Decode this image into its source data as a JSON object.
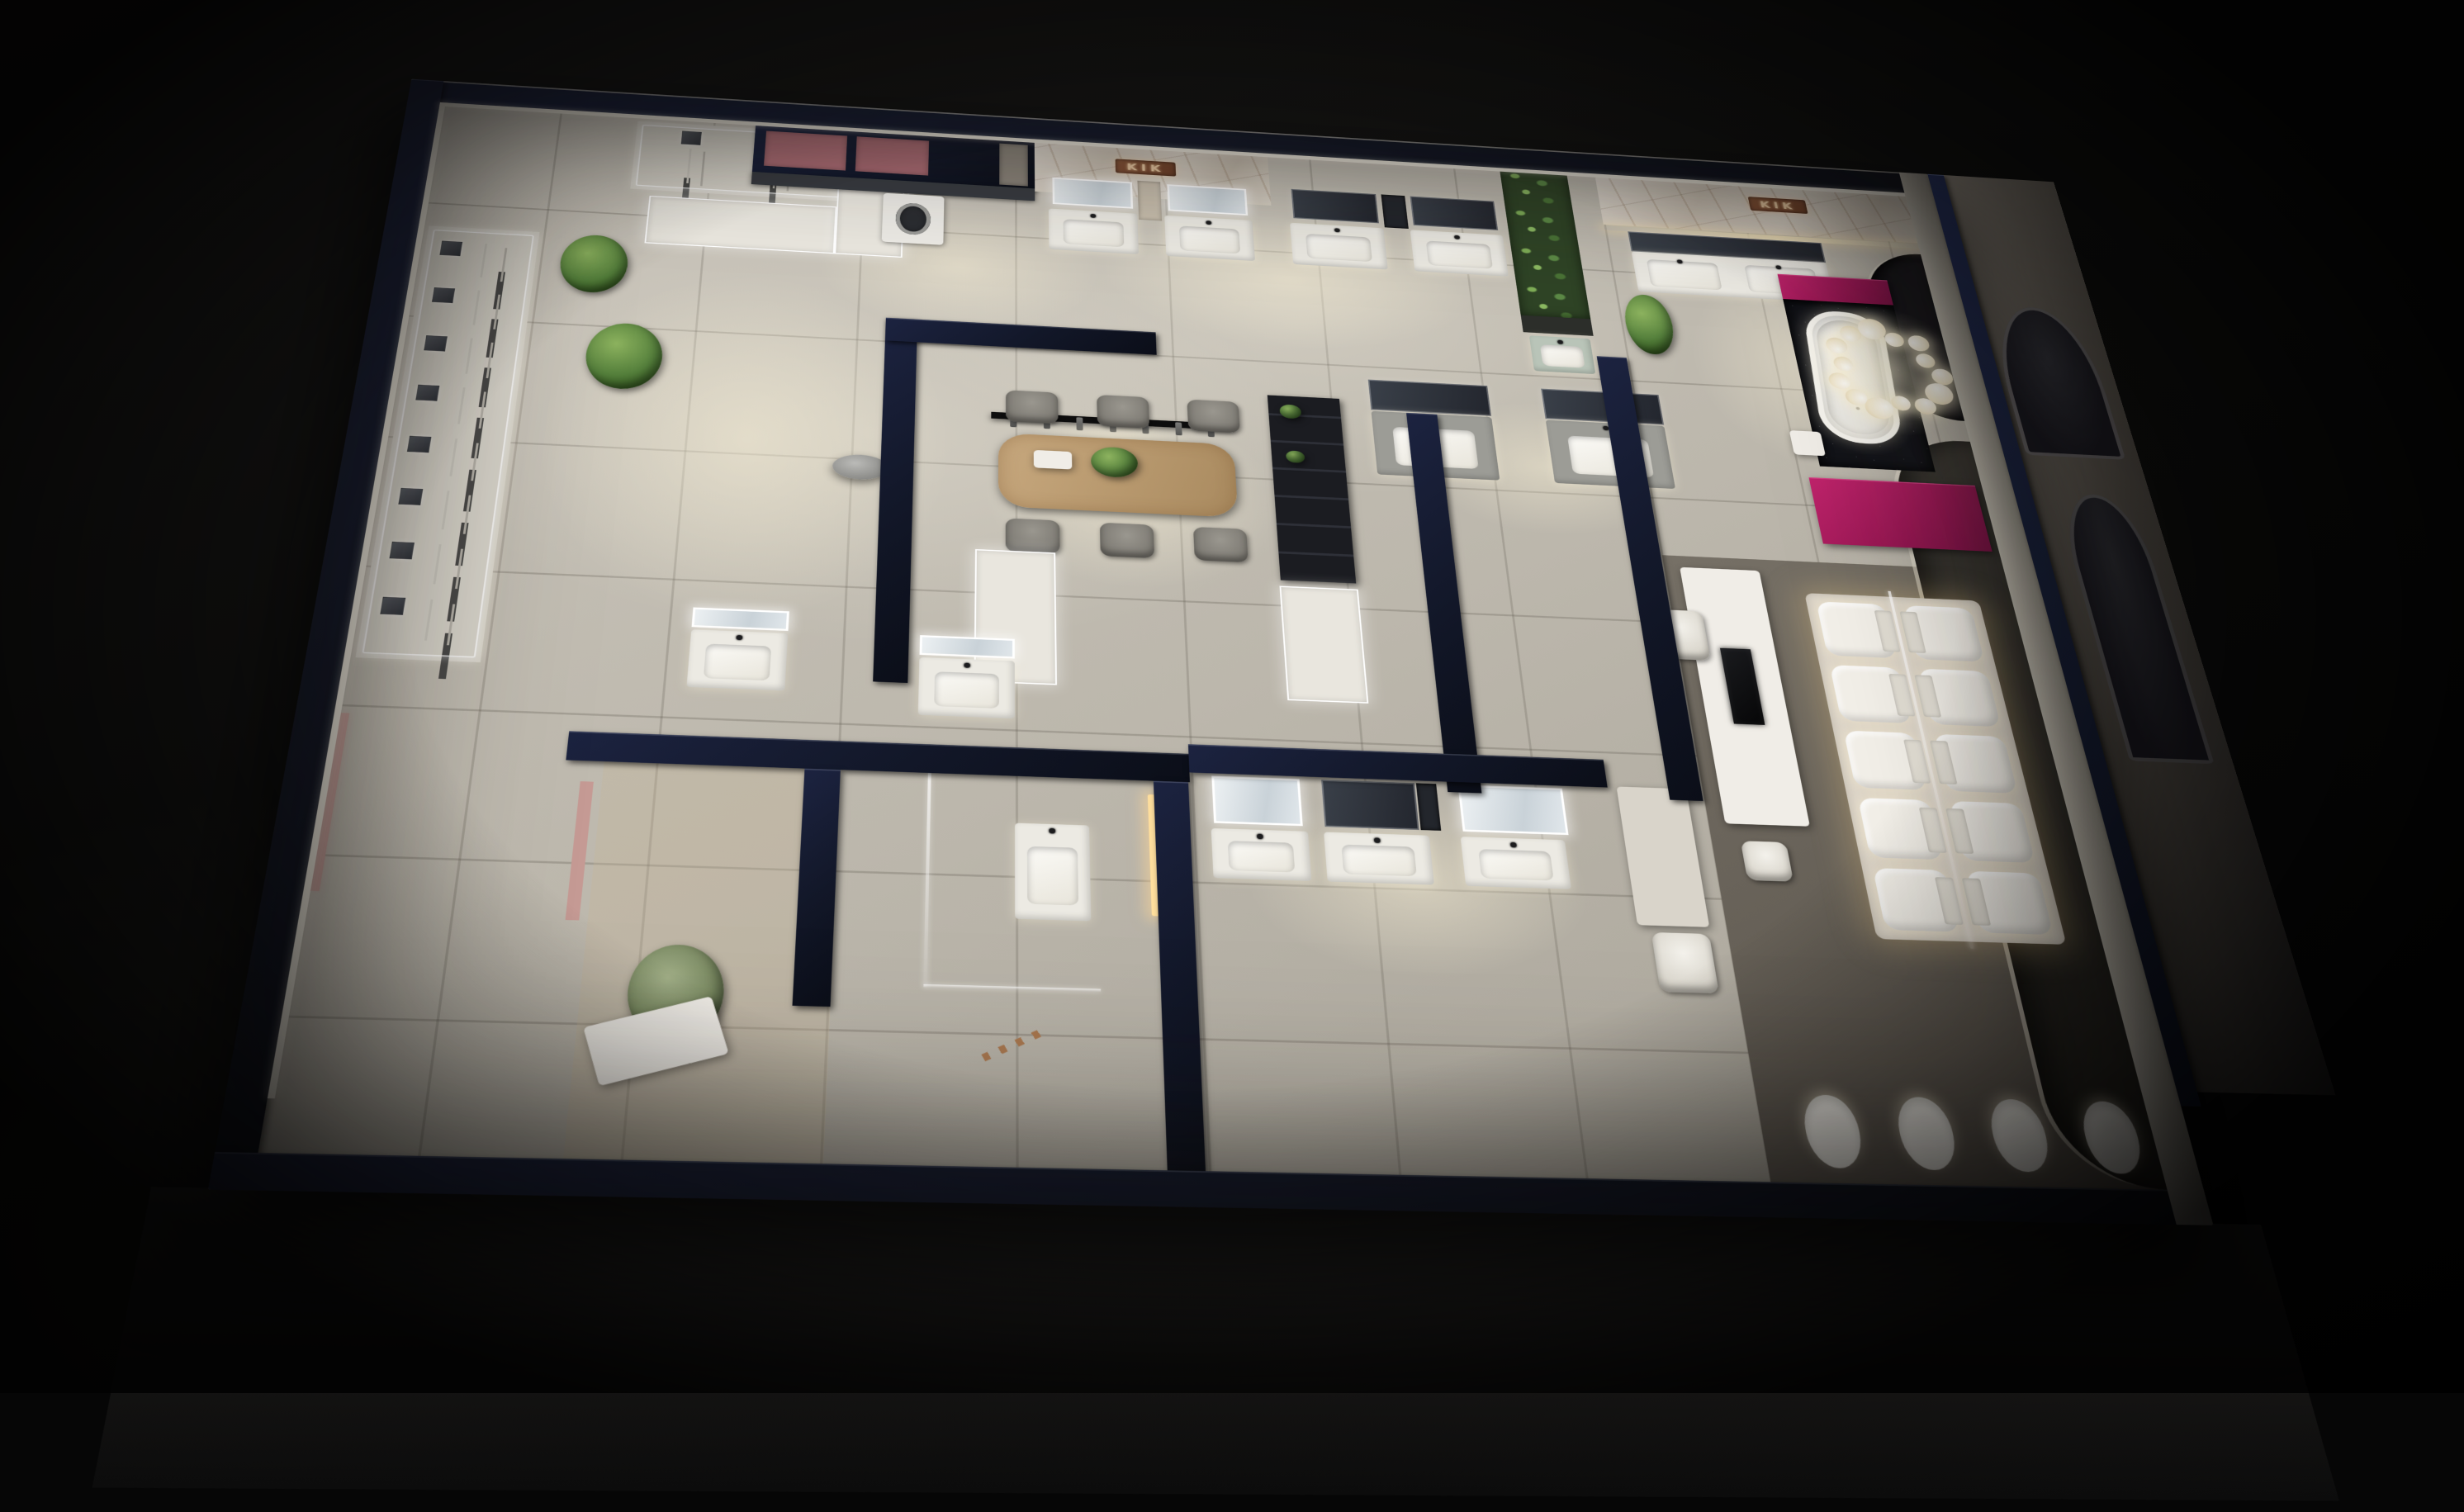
{
  "scene": {
    "type": "3d-aerial-render",
    "subject": "Bathroom and sanitary-ware showroom floor plan, aerial night view",
    "time": "night",
    "brand": "KIK"
  },
  "signs": {
    "stone_wall_sign": "KIK",
    "suite_sign": "KIK"
  },
  "palette": {
    "background": "#0a0a0a",
    "perimeter_wall": "#131a2c",
    "inner_wall_face": "#efeade",
    "floor_tile": "#c6c1b6",
    "carpet": "#6e675f",
    "dark_lounge": "#34312c",
    "magenta_accent": "#a81a5e",
    "dusty_rose_panel": "#b06f77",
    "blush_panel": "#c59a94",
    "marble_wall": "#d8d1c5",
    "copper_sign": "#8a5639",
    "plant_green": "#5c8a46",
    "wood_table": "#b5976e",
    "warm_led": "#ffdf9e",
    "cool_led": "#ffffff",
    "charcoal_fixture": "#17181c"
  },
  "inventory": {
    "shower_stations_left_wall": 8,
    "shower_stations_top_wall": 3,
    "pendant_hand_showers": 7,
    "toilets_on_platform": 10,
    "toilet_platform_rows": 5,
    "toilet_platform_cols": 2,
    "wall_hung_toilets": 4,
    "dining_chairs_per_side": 3,
    "chandelier_bubbles": 14,
    "vanity_units": 15,
    "bathtubs": 1,
    "washing_machines": 1,
    "dining_tables": 1,
    "tv_screens": 1,
    "potted_plants": 6
  }
}
